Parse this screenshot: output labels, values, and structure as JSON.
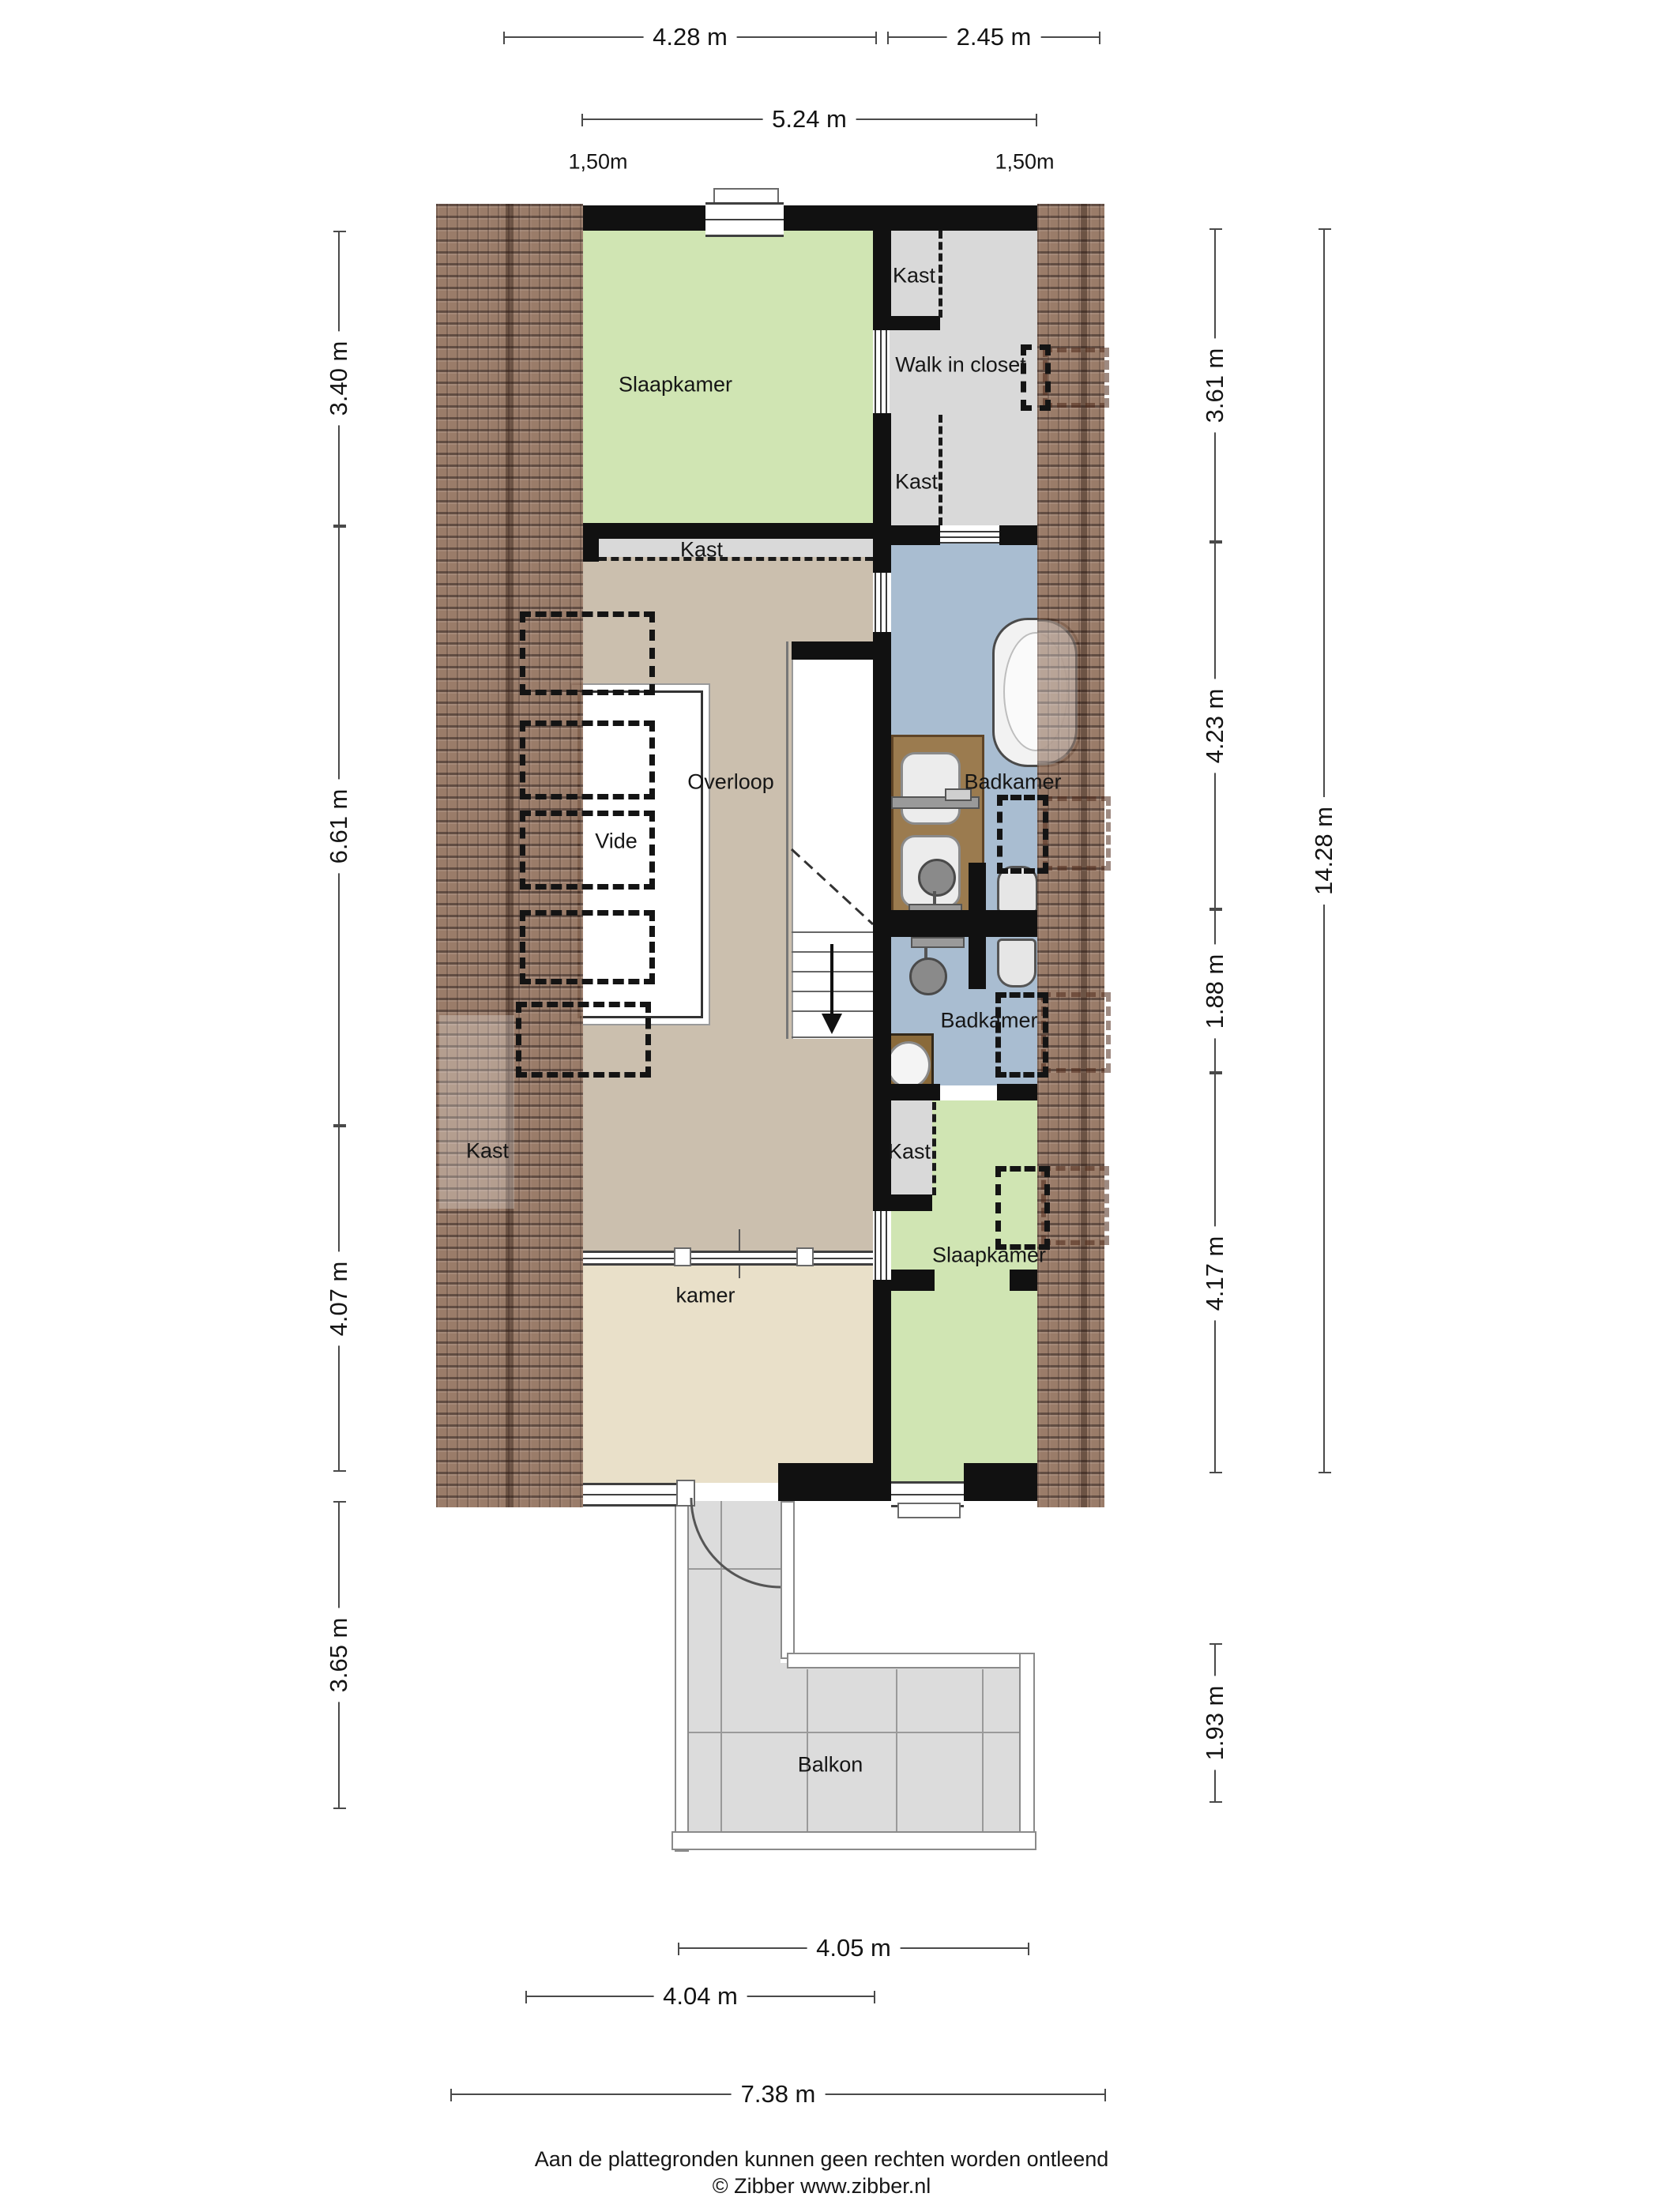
{
  "title": "Floor plan - second storey (attic) with balcony",
  "rooms": {
    "slaapkamer_top": "Slaapkamer",
    "kast": "Kast",
    "walk_in_closet": "Walk in closet",
    "overloop": "Overloop",
    "vide": "Vide",
    "badkamer_top": "Badkamer",
    "badkamer_bottom": "Badkamer",
    "kamer": "kamer",
    "slaapkamer_bottom": "Slaapkamer",
    "balkon": "Balkon",
    "kast_roof": "Kast"
  },
  "dims": {
    "t428": "4.28 m",
    "t245": "2.45 m",
    "t524": "5.24 m",
    "t150a": "1,50m",
    "t150b": "1,50m",
    "l340": "3.40 m",
    "l661": "6.61 m",
    "l407": "4.07 m",
    "l365": "3.65 m",
    "r361": "3.61 m",
    "r423": "4.23 m",
    "r188": "1.88 m",
    "r417": "4.17 m",
    "r1428": "14.28 m",
    "r193": "1.93 m",
    "b405": "4.05 m",
    "b404": "4.04 m",
    "b738": "7.38 m"
  },
  "footer": {
    "line1": "Aan de plattegronden kunnen geen rechten worden ontleend",
    "line2": "© Zibber www.zibber.nl"
  },
  "colors": {
    "wall": "#111111",
    "room_green": "#d0e5b3",
    "room_gray": "#d9d9d9",
    "room_tan": "#cbbfae",
    "room_cream": "#e9e0c9",
    "room_blue": "#a9bdd1",
    "roof_tile": "#8d6a55",
    "balcony_gray": "#dcdcdc",
    "wood": "#9b7b4f"
  }
}
